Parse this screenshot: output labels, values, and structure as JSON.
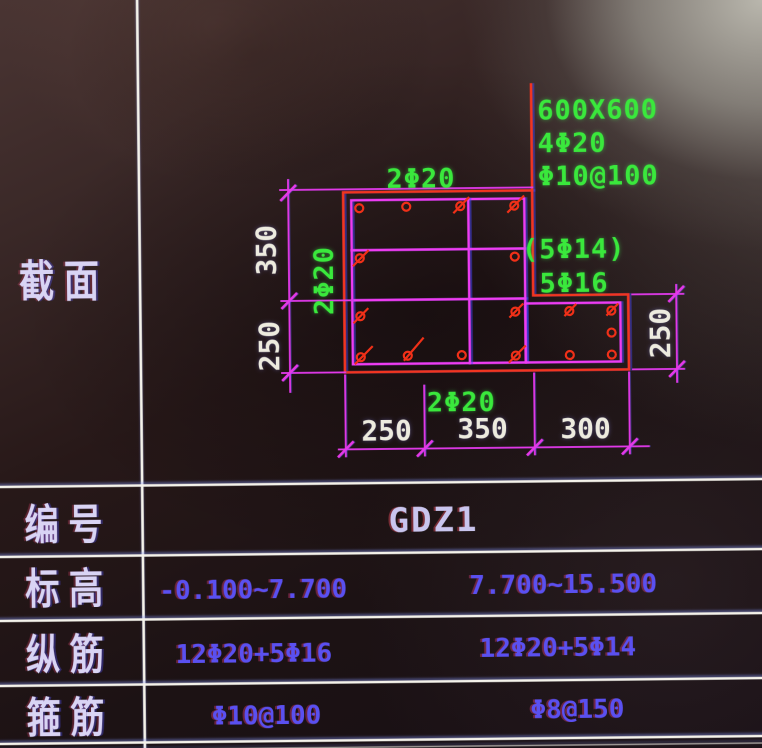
{
  "section_view": {
    "panel_label": "截 面",
    "callouts": {
      "top_bars": "2Φ20",
      "left_bars": "2Φ20",
      "bottom_bars": "2Φ20",
      "corner_size": "600X600",
      "corner_bars": "4Φ20",
      "corner_stirrup": "Φ10@100",
      "side_bars_optional": "(5Φ14)",
      "side_bars": "5Φ16"
    },
    "dimensions": {
      "left_top": "350",
      "left_bottom": "250",
      "bottom_left": "250",
      "bottom_middle": "350",
      "bottom_right": "300",
      "right": "250"
    }
  },
  "table": {
    "rows": [
      {
        "label": "编 号",
        "values": [
          "GDZ1"
        ]
      },
      {
        "label": "标 高",
        "values": [
          "-0.100~7.700",
          "7.700~15.500"
        ]
      },
      {
        "label": "纵 筋",
        "values": [
          "12Φ20+5Φ16",
          "12Φ20+5Φ14"
        ]
      },
      {
        "label": "箍 筋",
        "values": [
          "Φ10@100",
          "Φ8@150"
        ]
      }
    ]
  },
  "colors": {
    "outline_red": "#f23520",
    "stirrup_magenta": "#ee3cf1",
    "note_green": "#3ae83c",
    "dimension_white": "#edebdf",
    "table_value_blue": "#5a50f0",
    "table_label_lavender": "#d9d4f4"
  }
}
